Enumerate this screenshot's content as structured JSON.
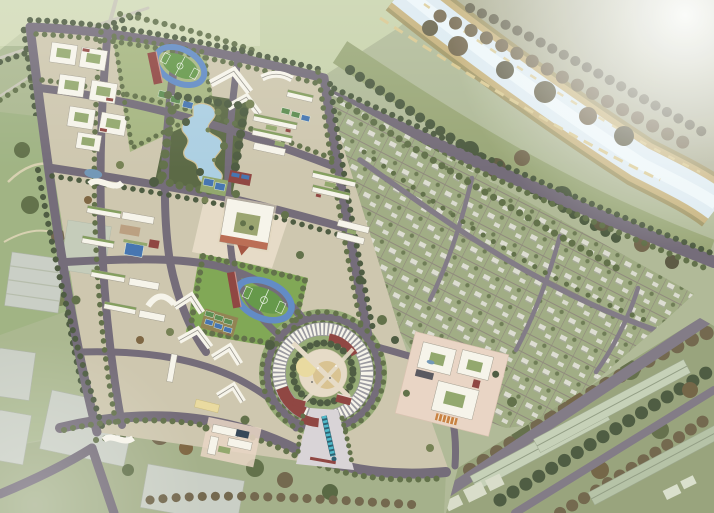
{
  "scene": {
    "title": "Aerial masterplan rendering of a campus development beside a river",
    "type": "architectural-aerial-rendering",
    "regions": [
      {
        "id": "nw-residential-quarter",
        "label": "Northwest courtyard housing quarter"
      },
      {
        "id": "north-stadium",
        "label": "North athletics track and football field"
      },
      {
        "id": "central-lake-park",
        "label": "Central park with winding lake"
      },
      {
        "id": "central-courtyard-building",
        "label": "Central square courtyard building"
      },
      {
        "id": "central-stadium",
        "label": "Central athletics track with sports courts"
      },
      {
        "id": "circular-complex",
        "label": "Circular assembly building with ring road"
      },
      {
        "id": "entrance-plaza",
        "label": "South entrance plaza with sculpture axis"
      },
      {
        "id": "southeast-courtyard-complex",
        "label": "Southeast courtyard complex on plinth"
      },
      {
        "id": "village-grid",
        "label": "Low-rise village grid district"
      },
      {
        "id": "river-corridor",
        "label": "River with landscaped terraced banks"
      },
      {
        "id": "industrial-belt",
        "label": "Southeast long sheds among dense trees"
      },
      {
        "id": "context-fields",
        "label": "Surrounding fields, park and context buildings"
      }
    ]
  },
  "palette": {
    "base": "#aeb794",
    "fields": "#c6d0a8",
    "fieldsLight": "#dde3c2",
    "road": "#6f6674",
    "roadMinor": "#7e7582",
    "campusGround": "#cdc5ac",
    "plaza": "#e6dac6",
    "plazaPink": "#e9d3c3",
    "entrance": "#d9d2d6",
    "lawn": "#8fa468",
    "lawnBright": "#7ca44f",
    "fieldGreen": "#5f9443",
    "trackBlue": "#5c86c3",
    "courtBlue": "#3f6fae",
    "courtGreen": "#56874a",
    "lake": "#a9cde2",
    "river": "#dceaf2",
    "riverLight": "#f0f8fb",
    "bank": "#c4ad74",
    "bankDark": "#9a8c55",
    "bankPath": "#d8c58a",
    "bldg": "#f7f4ea",
    "roofGreen": "#7f9a58",
    "roofDark": "#54525a",
    "maroon": "#8c3e3a",
    "treeDark": "#47553a",
    "treeMid": "#5c6b43",
    "treeOlive": "#717c4d",
    "treeBrown": "#6e6147",
    "treeRust": "#7a5f3b",
    "village": "#9da980",
    "villageLane": "#8c8478",
    "house": "#dddcd1",
    "indus": "#95a078",
    "indusRoof": "#c5cfb6",
    "grayBldg": "#c9cdc4",
    "sand": "#d9c08e",
    "paleYellow": "#e9d89c",
    "teal": "#49b6c8",
    "tealDark": "#24596b",
    "haze": "#ffffff"
  }
}
